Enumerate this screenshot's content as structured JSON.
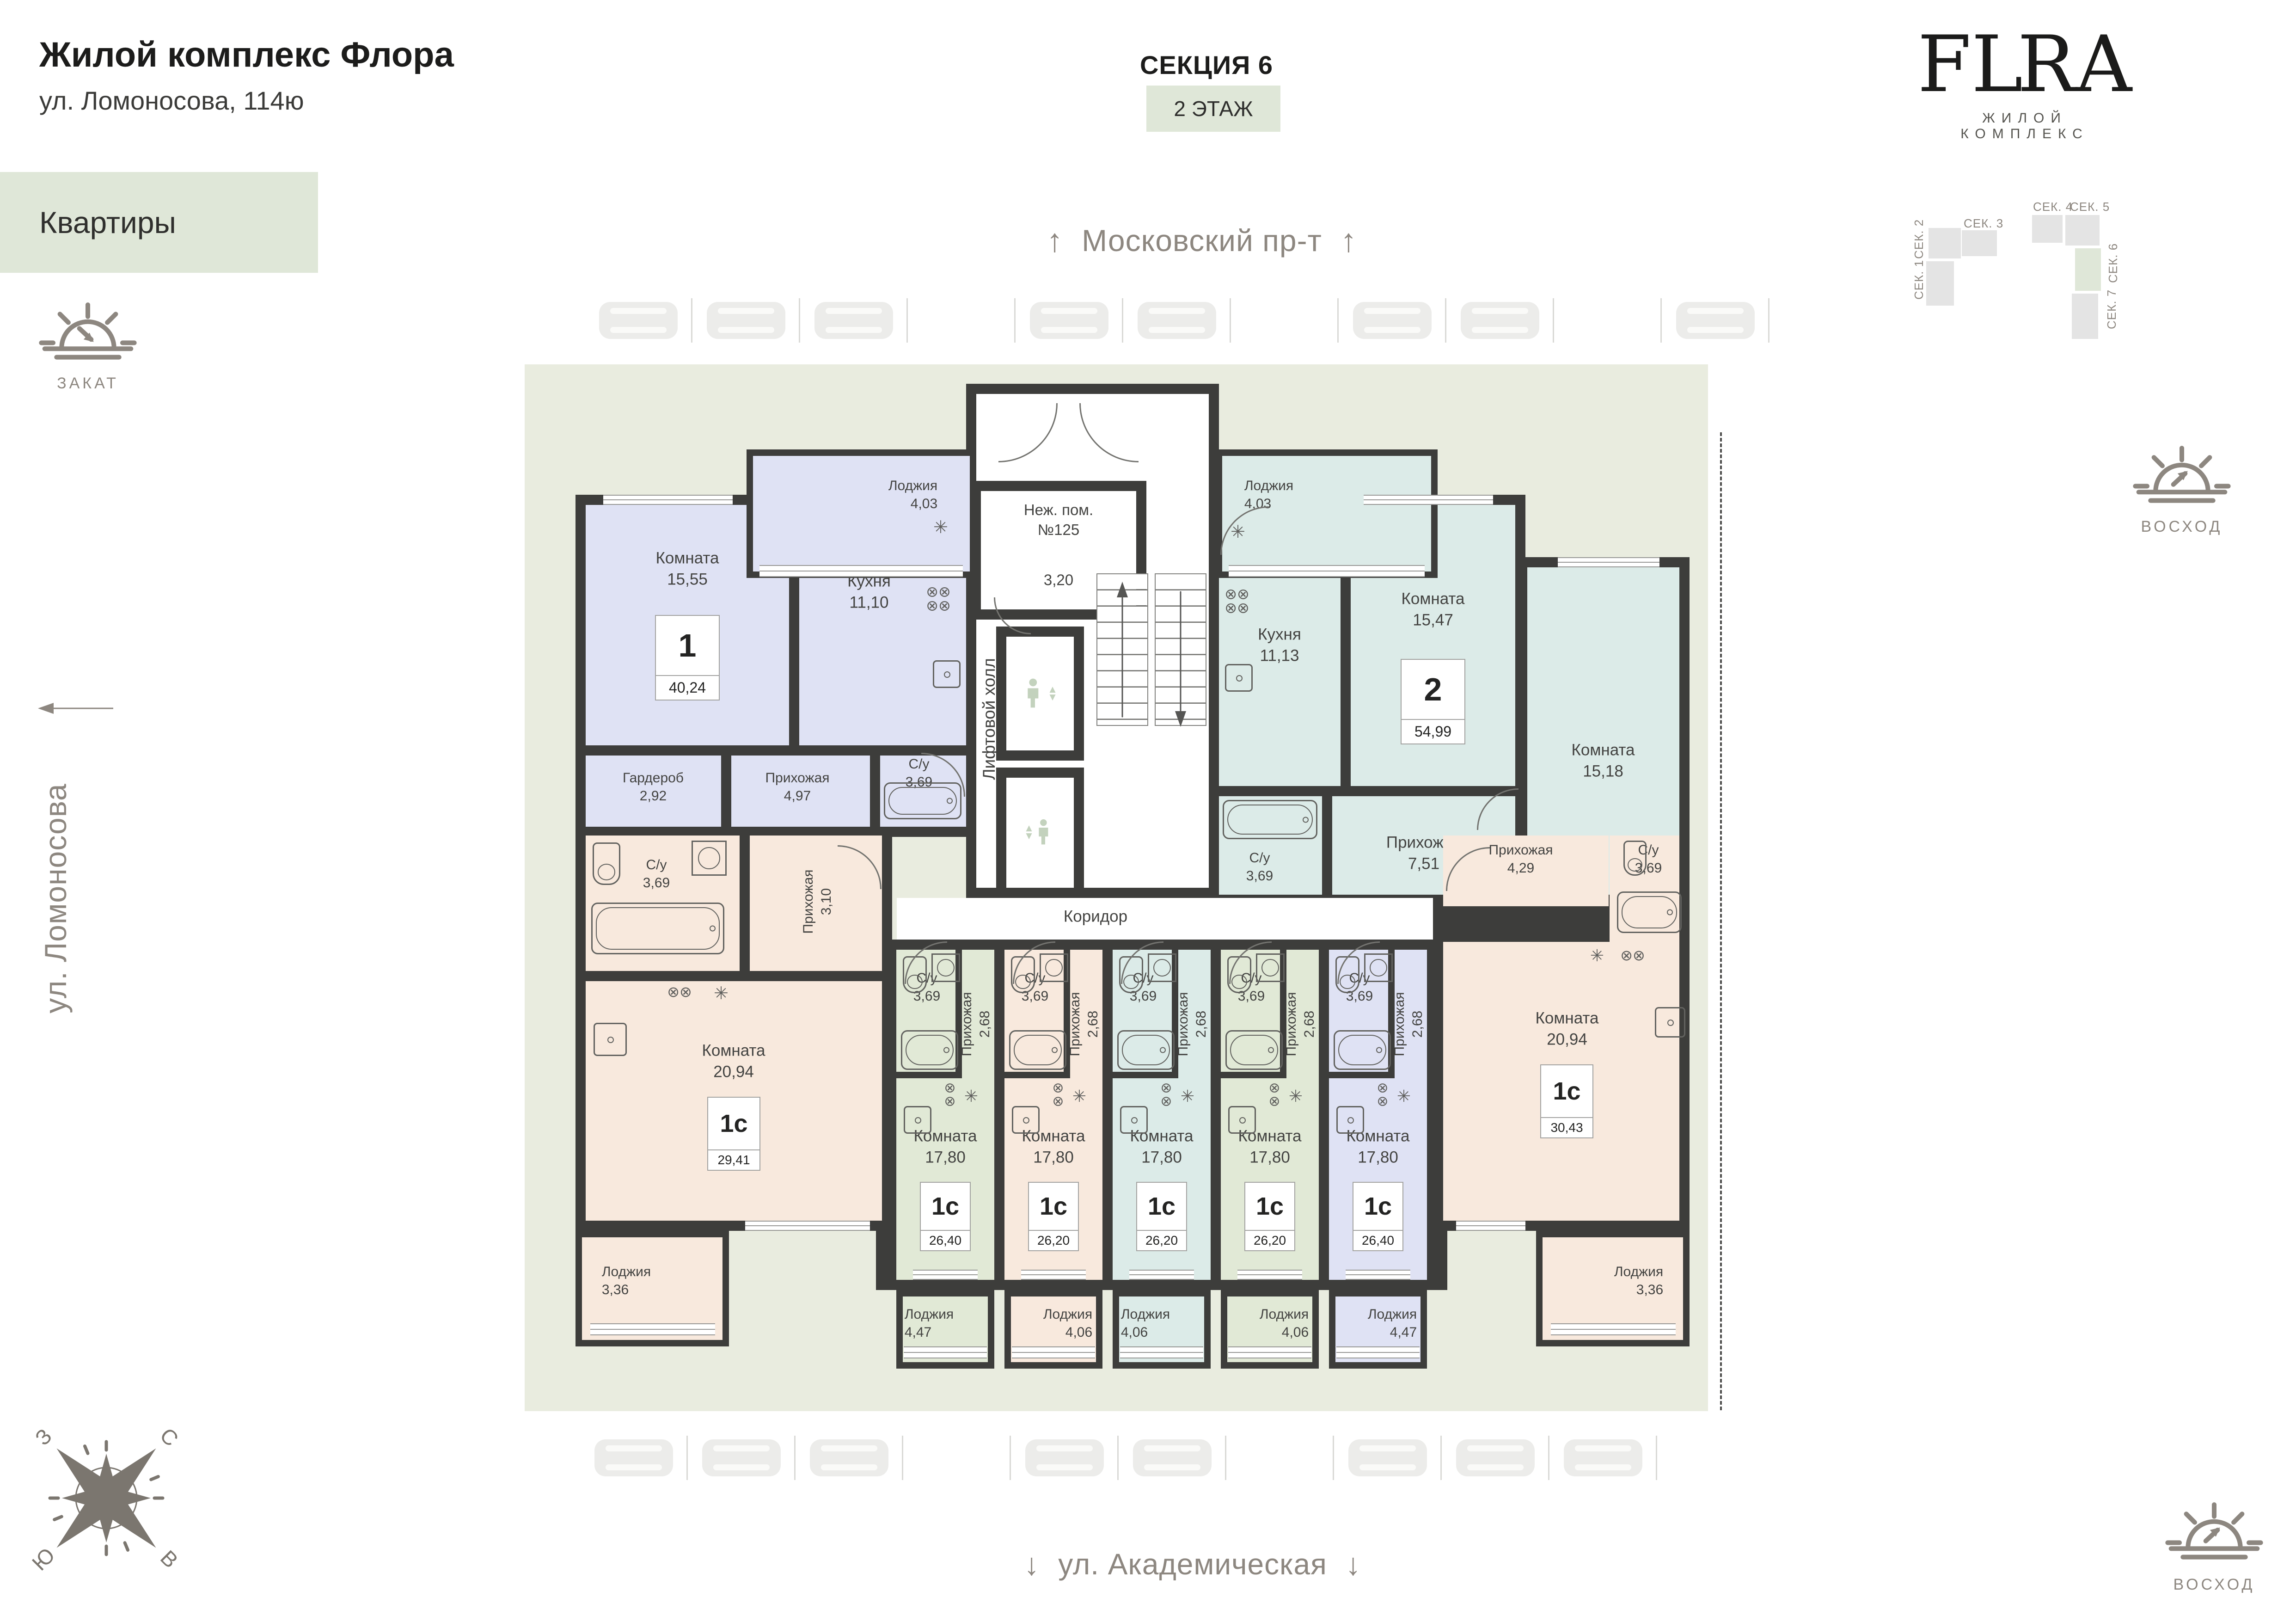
{
  "header": {
    "title": "Жилой комплекс Флора",
    "subtitle": "ул. Ломоносова, 114ю",
    "badge": "Квартиры"
  },
  "section": {
    "name": "СЕКЦИЯ 6",
    "floor": "2 ЭТАЖ"
  },
  "streets": {
    "top": "Московский пр-т",
    "left": "ул. Ломоносова",
    "bottom": "ул. Академическая"
  },
  "icons": {
    "arrow_up": "↑",
    "arrow_down": "↓"
  },
  "logo": {
    "pre": "FL",
    "post": "RA",
    "tagline": "ЖИЛОЙ КОМПЛЕКС"
  },
  "suns": {
    "sunset": "ЗАКАТ",
    "sunrise": "ВОСХОД"
  },
  "compass": {
    "n": "С",
    "e": "В",
    "s": "Ю",
    "w": "З"
  },
  "map": {
    "s1": "СЕК. 1",
    "s2": "СЕК. 2",
    "s3": "СЕК. 3",
    "s4": "СЕК. 4",
    "s5": "СЕК. 5",
    "s6": "СЕК. 6",
    "s7": "СЕК. 7"
  },
  "core": {
    "hall": "Лифтовой холл",
    "corridor": "Коридор",
    "nezh1": "Неж. пом.",
    "nezh2": "№125",
    "nezh_area": "3,20",
    "stove": "⊗⊗",
    "stove2": "⊗⊗\n⊗⊗",
    "star": "✳"
  },
  "apartments": [
    {
      "type": "1",
      "area": "40,24",
      "rooms": {
        "living": {
          "name": "Комната",
          "area": "15,55"
        },
        "kitchen": {
          "name": "Кухня",
          "area": "11,10"
        },
        "wardrobe": {
          "name": "Гардероб",
          "area": "2,92"
        },
        "hallway": {
          "name": "Прихожая",
          "area": "4,97"
        },
        "bathroom": {
          "name": "С/у",
          "area": "3,69"
        },
        "loggia": {
          "name": "Лоджия",
          "area": "4,03"
        }
      }
    },
    {
      "type": "2",
      "area": "54,99",
      "rooms": {
        "kitchen": {
          "name": "Кухня",
          "area": "11,13"
        },
        "living1": {
          "name": "Комната",
          "area": "15,47"
        },
        "living2": {
          "name": "Комната",
          "area": "15,18"
        },
        "bathroom": {
          "name": "С/у",
          "area": "3,69"
        },
        "hallway": {
          "name": "Прихожая",
          "area": "7,51"
        },
        "loggia": {
          "name": "Лоджия",
          "area": "4,03"
        }
      }
    },
    {
      "type": "1с",
      "area": "29,41",
      "rooms": {
        "living": {
          "name": "Комната",
          "area": "20,94"
        },
        "bathroom": {
          "name": "С/у",
          "area": "3,69"
        },
        "hallway": {
          "name": "Прихожая",
          "area": "3,10"
        },
        "loggia": {
          "name": "Лоджия",
          "area": "3,36"
        }
      }
    },
    {
      "type": "1с",
      "area": "26,40",
      "rooms": {
        "living": {
          "name": "Комната",
          "area": "17,80"
        },
        "bathroom": {
          "name": "С/у",
          "area": "3,69"
        },
        "hallway": {
          "name": "Прихожая",
          "area": "2,68"
        },
        "loggia": {
          "name": "Лоджия",
          "area": "4,47"
        }
      }
    },
    {
      "type": "1с",
      "area": "26,20",
      "rooms": {
        "living": {
          "name": "Комната",
          "area": "17,80"
        },
        "bathroom": {
          "name": "С/у",
          "area": "3,69"
        },
        "hallway": {
          "name": "Прихожая",
          "area": "2,68"
        },
        "loggia": {
          "name": "Лоджия",
          "area": "4,06"
        }
      }
    },
    {
      "type": "1с",
      "area": "26,20",
      "rooms": {
        "living": {
          "name": "Комната",
          "area": "17,80"
        },
        "bathroom": {
          "name": "С/у",
          "area": "3,69"
        },
        "hallway": {
          "name": "Прихожая",
          "area": "2,68"
        },
        "loggia": {
          "name": "Лоджия",
          "area": "4,06"
        }
      }
    },
    {
      "type": "1с",
      "area": "26,20",
      "rooms": {
        "living": {
          "name": "Комната",
          "area": "17,80"
        },
        "bathroom": {
          "name": "С/у",
          "area": "3,69"
        },
        "hallway": {
          "name": "Прихожая",
          "area": "2,68"
        },
        "loggia": {
          "name": "Лоджия",
          "area": "4,06"
        }
      }
    },
    {
      "type": "1с",
      "area": "26,40",
      "rooms": {
        "living": {
          "name": "Комната",
          "area": "17,80"
        },
        "bathroom": {
          "name": "С/у",
          "area": "3,69"
        },
        "hallway": {
          "name": "Прихожая",
          "area": "2,68"
        },
        "loggia": {
          "name": "Лоджия",
          "area": "4,47"
        }
      }
    },
    {
      "type": "1с",
      "area": "30,43",
      "rooms": {
        "living": {
          "name": "Комната",
          "area": "20,94"
        },
        "hallway": {
          "name": "Прихожая",
          "area": "4,29"
        },
        "bathroom": {
          "name": "С/у",
          "area": "3,69"
        },
        "loggia": {
          "name": "Лоджия",
          "area": "3,36"
        }
      }
    }
  ]
}
